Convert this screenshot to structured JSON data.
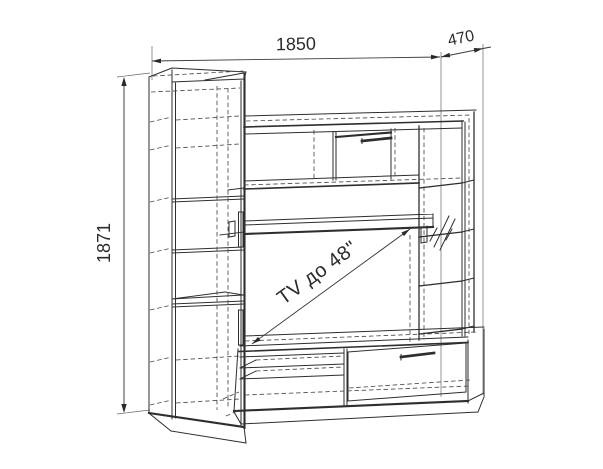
{
  "page": {
    "background_color": "#ffffff"
  },
  "drawing": {
    "line_color": "#2e2e2e",
    "dimension_color": "#3c3c3c",
    "dimensions": {
      "width": "1850",
      "depth": "470",
      "height": "1871"
    },
    "annotations": {
      "tv_max_size": "TV до 48\""
    },
    "symbols": {
      "glass": "glass-hatch-icon"
    }
  }
}
